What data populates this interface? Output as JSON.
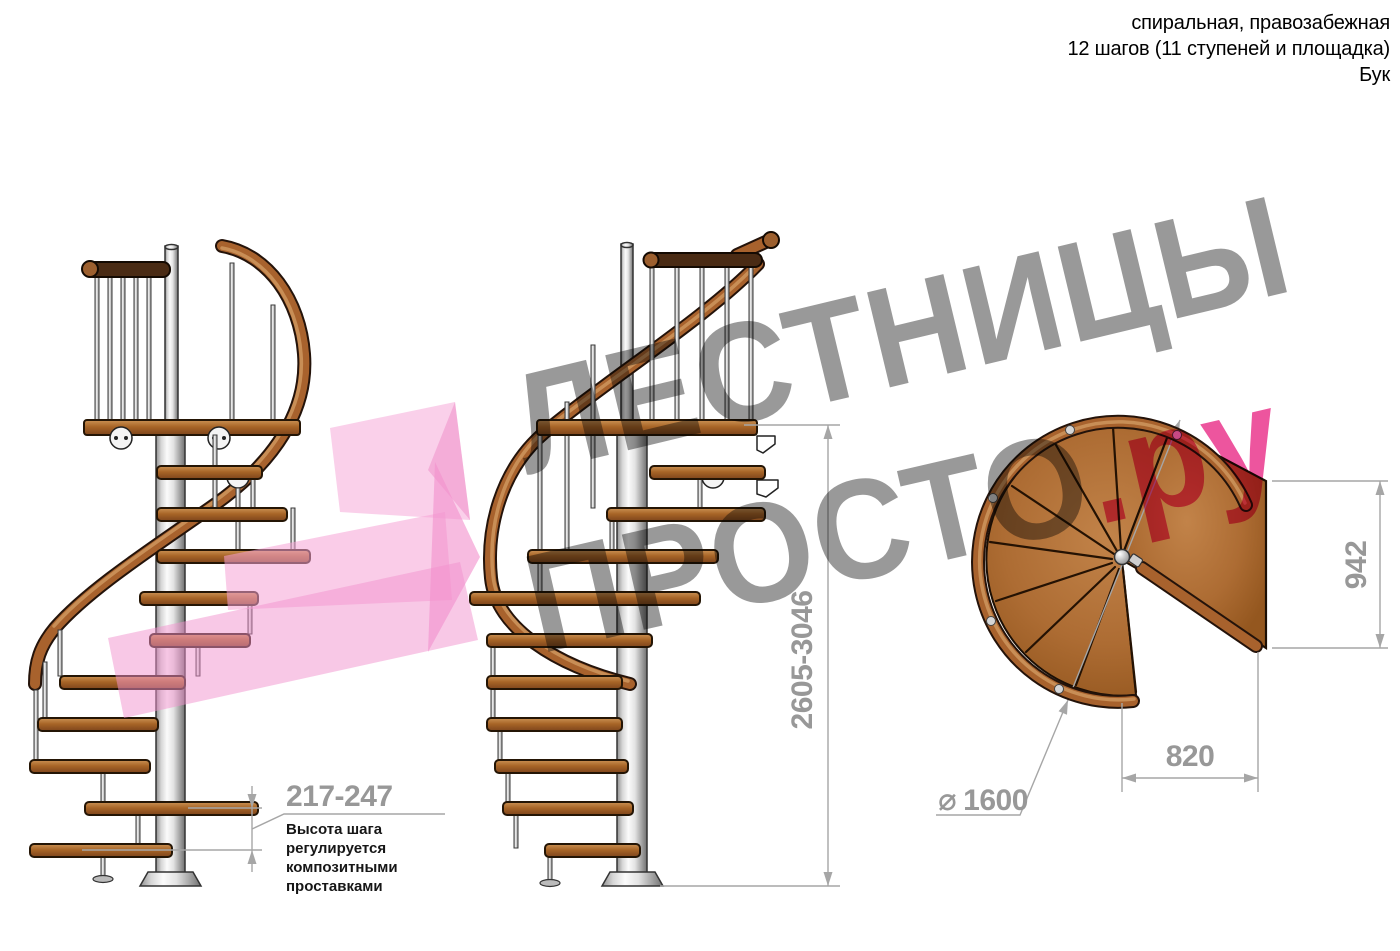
{
  "header": {
    "line1": "спиральная, правозабежная",
    "line2": "12 шагов (11 ступеней и площадка)",
    "line3": "Бук"
  },
  "watermark": {
    "word1": "ЛЕСТНИЦЫ",
    "word2": "ПРОСТО",
    "word2_suffix": ".ру"
  },
  "dimensions": {
    "step_height": {
      "value": "217-247",
      "note": "Высота шага\nрегулируется\nкомпозитными\nпроставками"
    },
    "total_height": {
      "value": "2605-3046"
    },
    "plan_depth": {
      "value": "942"
    },
    "plan_width": {
      "value": "820"
    },
    "diameter": {
      "symbol": "⌀",
      "value": "1600"
    }
  },
  "colors": {
    "wood": "#a8622d",
    "dark_wood": "#4a2b14",
    "steel": "#d9d9d9",
    "dimension_gray": "#989898",
    "watermark_gray": "#9a9a9a",
    "watermark_pink": "#e83c96",
    "arrow_pink": "#f2a0d2"
  }
}
